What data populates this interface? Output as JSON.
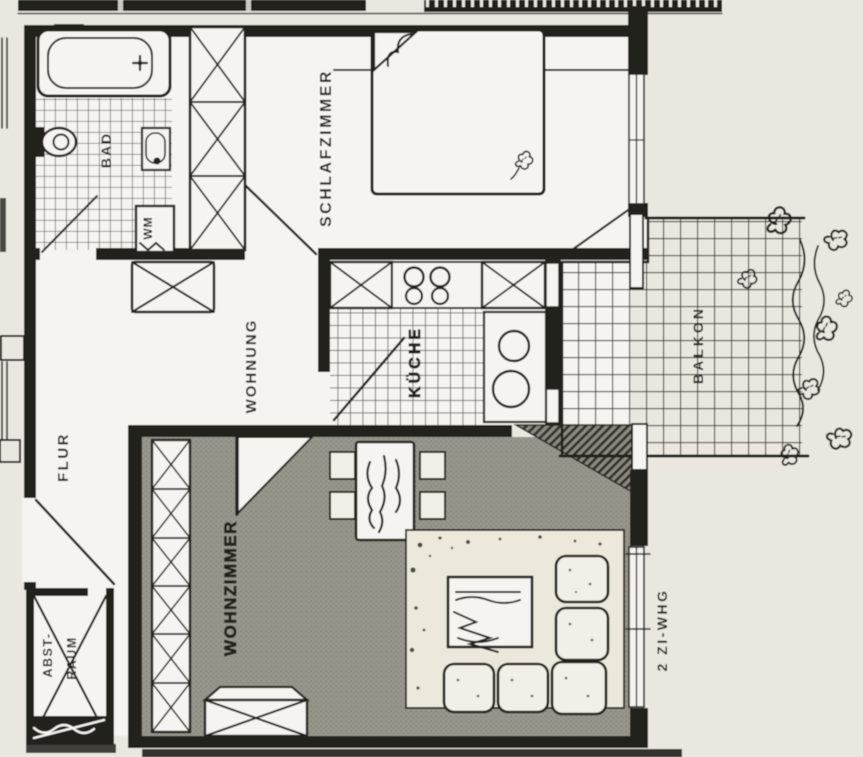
{
  "plan": {
    "apartment_type": "2 ZI-WHG"
  },
  "rooms": {
    "bad": {
      "label": "BAD"
    },
    "schlafzimmer": {
      "label": "SCHLAFZIMMER"
    },
    "flur": {
      "label": "FLUR"
    },
    "wohnung": {
      "label": "WOHNUNG"
    },
    "kueche": {
      "label": "KÜCHE"
    },
    "balkon": {
      "label": "BALKON"
    },
    "wohnzimmer": {
      "label": "WOHNZIMMER"
    },
    "abstellraum": {
      "label_line1": "ABST-",
      "label_line2": "RAUM"
    }
  },
  "appliances": {
    "washing_machine_label": "WM"
  },
  "colors": {
    "paper": "#e9e7e0",
    "room": "#f5f4f0",
    "ink": "#24221e",
    "floor-gray": "#98958c",
    "floor-dot": "#7e7b73",
    "rug": "#ece9dc",
    "cushion": "#f1efe7",
    "tile-line": "#35322c",
    "hatch-base": "#8e8b83"
  }
}
